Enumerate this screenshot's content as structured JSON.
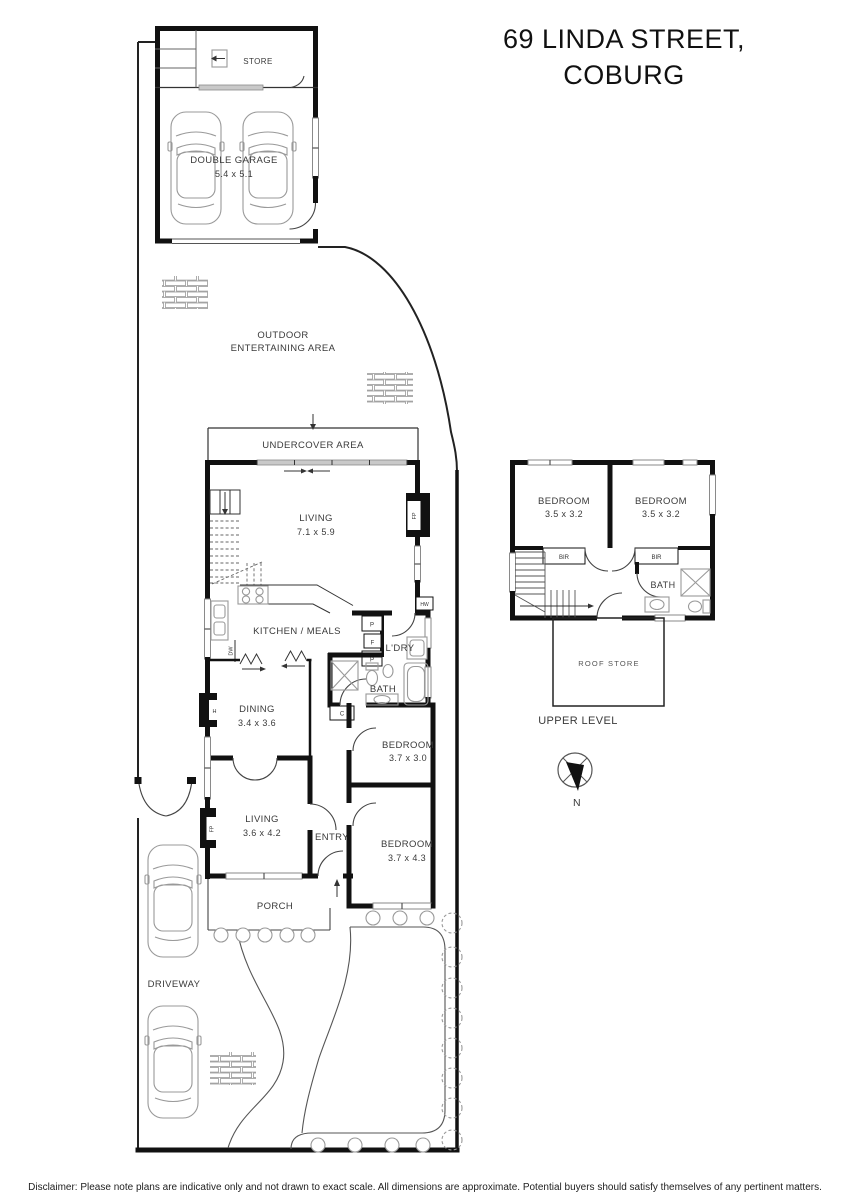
{
  "title": {
    "line1": "69 LINDA STREET,",
    "line2": "COBURG"
  },
  "disclaimer": "Disclaimer: Please note plans are indicative only and not drawn to exact scale. All dimensions are approximate. Potential buyers should satisfy themselves of any pertinent matters.",
  "colors": {
    "wall": "#111111",
    "fixture_gray": "#999999",
    "label_gray": "#3a3a3a"
  },
  "ground_floor": {
    "store": "STORE",
    "garage": {
      "name": "DOUBLE GARAGE",
      "dims": "5.4 x 5.1"
    },
    "outdoor": {
      "line1": "OUTDOOR",
      "line2": "ENTERTAINING AREA"
    },
    "undercover": "UNDERCOVER AREA",
    "living_rear": {
      "name": "LIVING",
      "dims": "7.1 x 5.9"
    },
    "kitchen": "KITCHEN / MEALS",
    "laundry": "L'DRY",
    "bath": "BATH",
    "dining": {
      "name": "DINING",
      "dims": "3.4 x 3.6"
    },
    "bedroom_rear": {
      "name": "BEDROOM",
      "dims": "3.7 x 3.0"
    },
    "living_front": {
      "name": "LIVING",
      "dims": "3.6 x 4.2"
    },
    "entry": "ENTRY",
    "bedroom_front": {
      "name": "BEDROOM",
      "dims": "3.7 x 4.3"
    },
    "porch": "PORCH",
    "driveway": "DRIVEWAY",
    "fixtures": {
      "hw": "HW",
      "fp_living": "FP",
      "fp_lounge": "FP",
      "heater": "H",
      "dishwasher": "DW",
      "pantry1": "P",
      "fridge": "F",
      "pantry2": "P",
      "cupboard": "C"
    }
  },
  "upper_floor": {
    "label": "UPPER LEVEL",
    "bedroom_left": {
      "name": "BEDROOM",
      "dims": "3.5 x 3.2"
    },
    "bedroom_right": {
      "name": "BEDROOM",
      "dims": "3.5 x 3.2"
    },
    "bath": "BATH",
    "roof_store": "ROOF STORE",
    "bir_left": "BIR",
    "bir_right": "BIR"
  },
  "compass": {
    "north": "N"
  }
}
